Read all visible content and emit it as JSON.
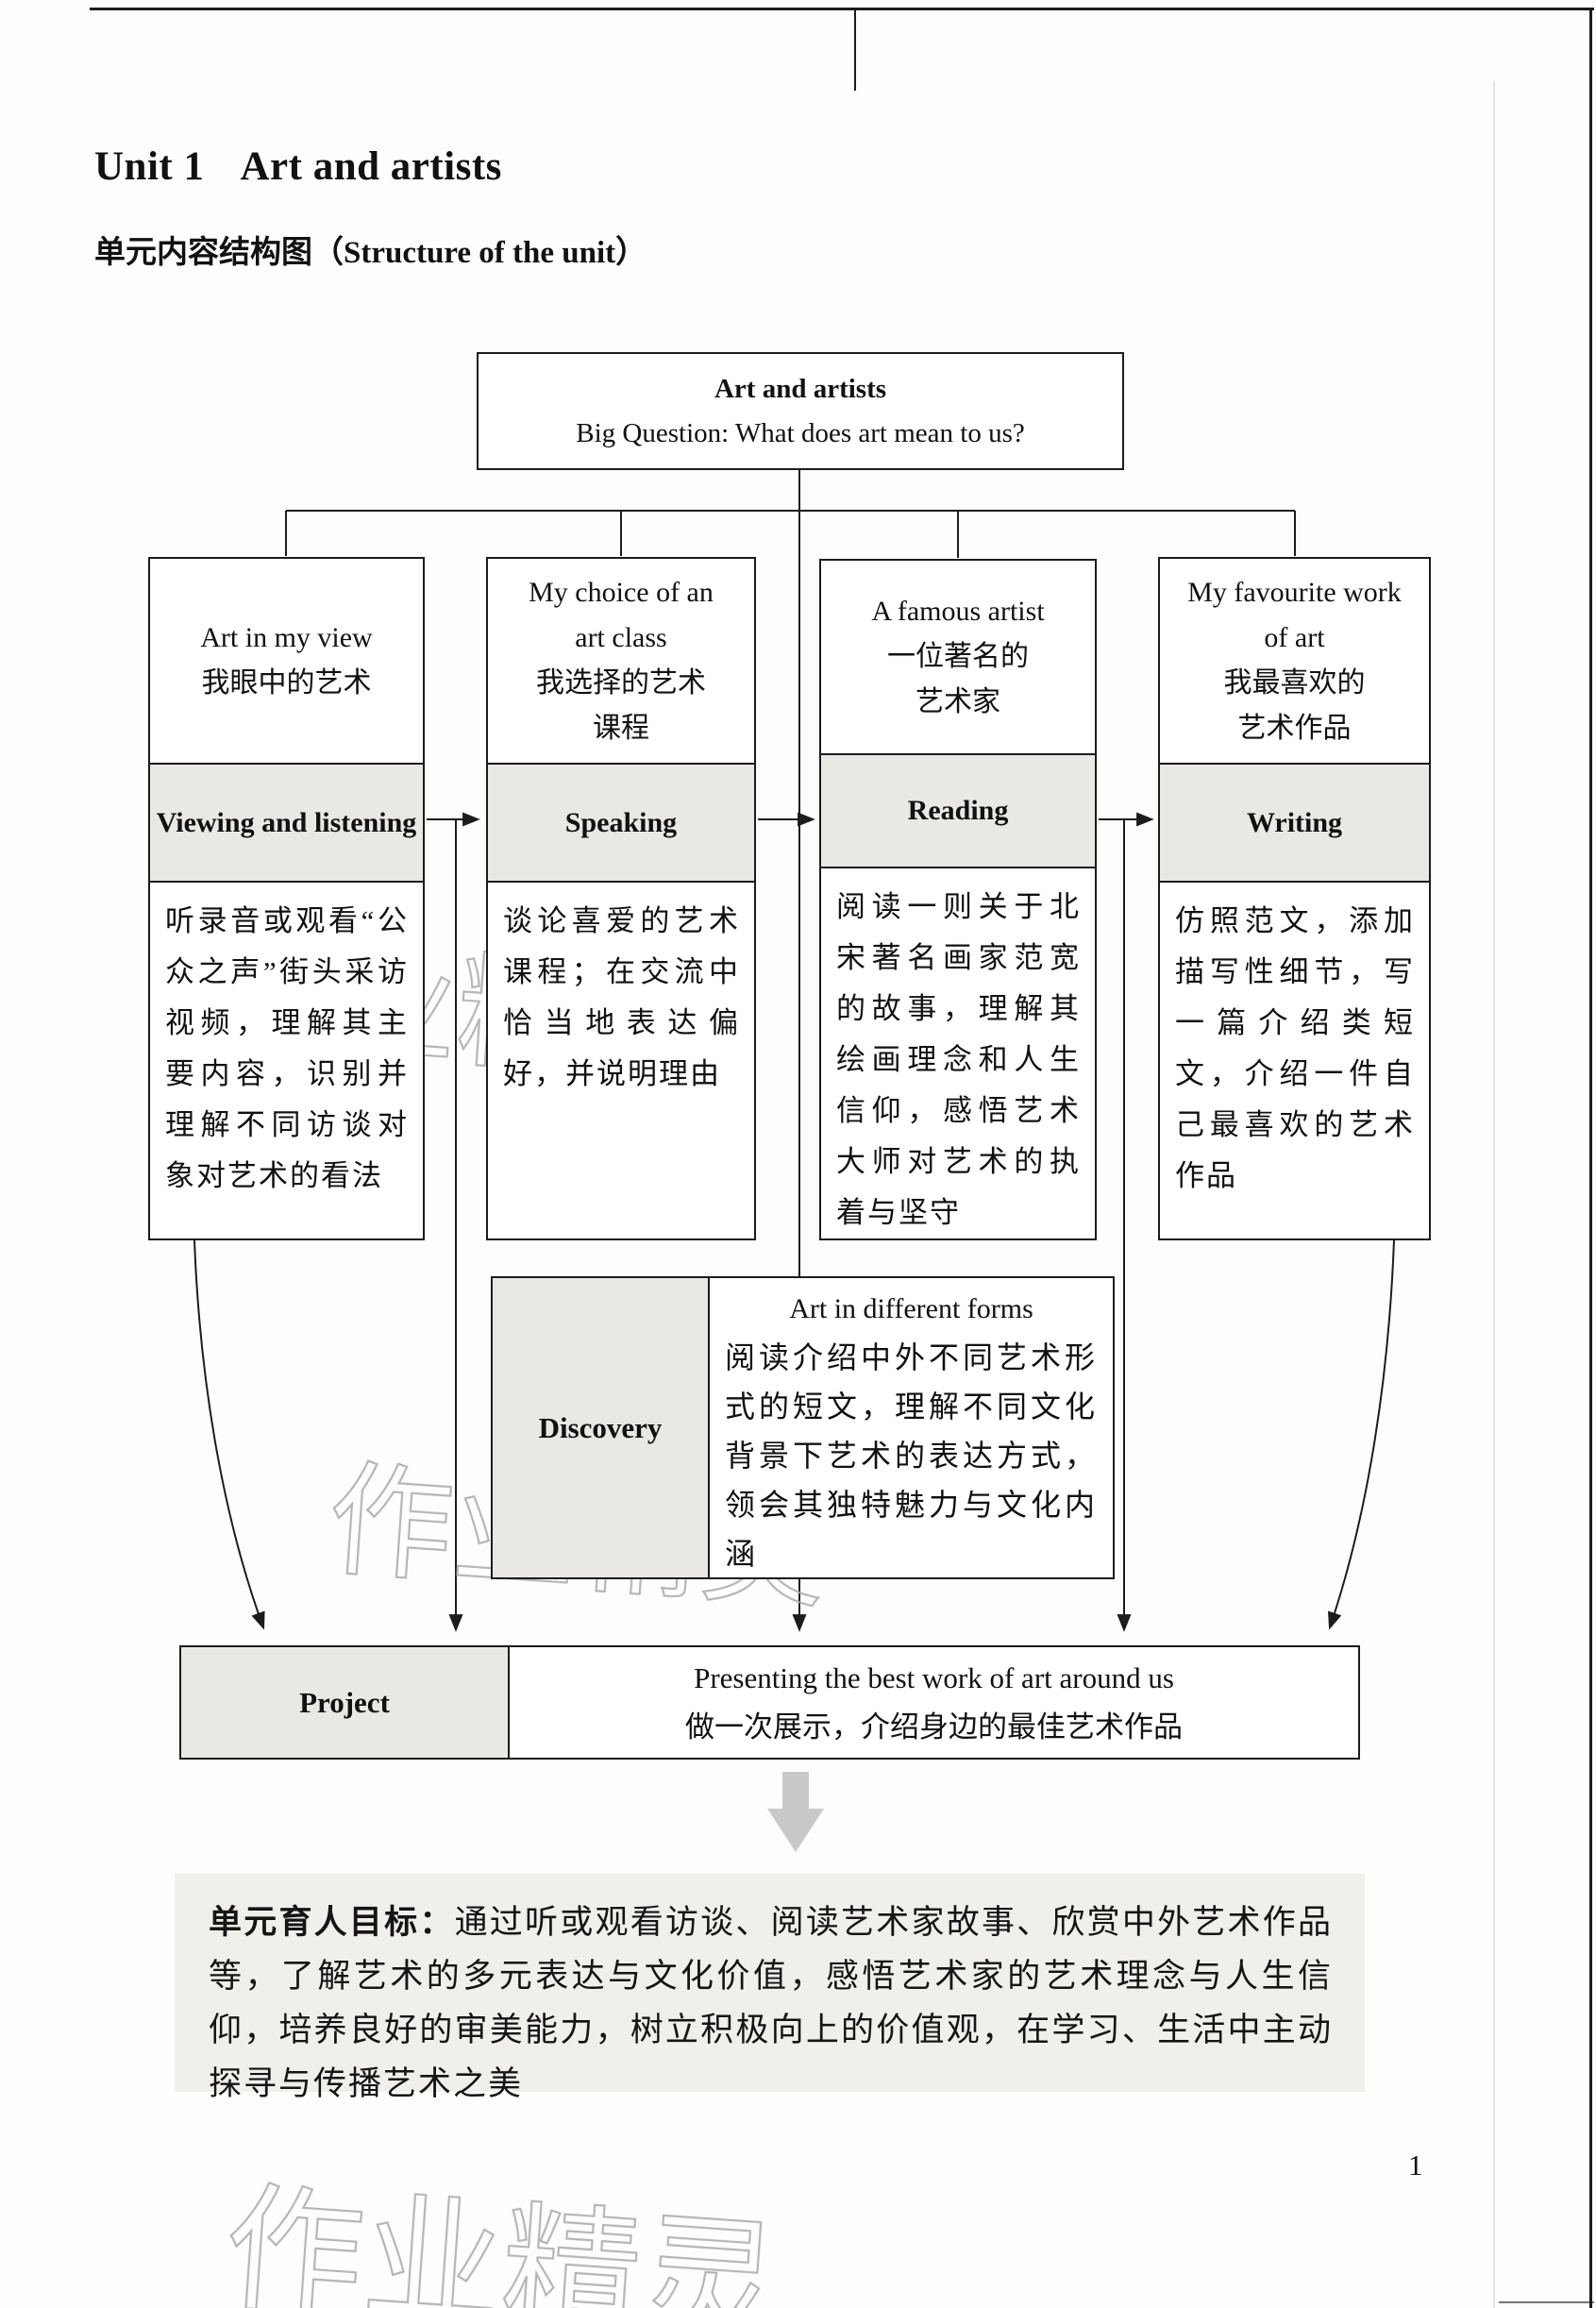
{
  "page": {
    "unit_label": "Unit 1",
    "unit_name": "Art and artists",
    "section_title_zh": "单元内容结构图",
    "section_title_en": "（Structure of the unit）",
    "page_number": "1",
    "watermark": "作业精灵"
  },
  "diagram": {
    "root": {
      "title": "Art and artists",
      "subtitle": "Big Question: What does art mean to us?"
    },
    "columns": [
      {
        "topic_lines": [
          "Art in my view",
          "我眼中的艺术"
        ],
        "skill": "Viewing and listening",
        "description": "听录音或观看“公众之声”街头采访视频，理解其主要内容，识别并理解不同访谈对象对艺术的看法"
      },
      {
        "topic_lines": [
          "My choice of an",
          "art class",
          "我选择的艺术",
          "课程"
        ],
        "skill": "Speaking",
        "description": "谈论喜爱的艺术课程；在交流中恰当地表达偏好，并说明理由"
      },
      {
        "topic_lines": [
          "A famous artist",
          "一位著名的",
          "艺术家"
        ],
        "skill": "Reading",
        "description": "阅读一则关于北宋著名画家范宽的故事，理解其绘画理念和人生信仰，感悟艺术大师对艺术的执着与坚守"
      },
      {
        "topic_lines": [
          "My favourite work",
          "of art",
          "我最喜欢的",
          "艺术作品"
        ],
        "skill": "Writing",
        "description": "仿照范文，添加描写性细节，写一篇介绍类短文，介绍一件自己最喜欢的艺术作品"
      }
    ],
    "discovery": {
      "label": "Discovery",
      "title_en": "Art in different forms",
      "description": "阅读介绍中外不同艺术形式的短文，理解不同文化背景下艺术的表达方式，领会其独特魅力与文化内涵"
    },
    "project": {
      "label": "Project",
      "line_en": "Presenting the best work of art around us",
      "line_zh": "做一次展示，介绍身边的最佳艺术作品"
    },
    "goal": {
      "lead": "单元育人目标：",
      "text": "通过听或观看访谈、阅读艺术家故事、欣赏中外艺术作品等，了解艺术的多元表达与文化价值，感悟艺术家的艺术理念与人生信仰，培养良好的审美能力，树立积极向上的价值观，在学习、生活中主动探寻与传播艺术之美"
    }
  }
}
